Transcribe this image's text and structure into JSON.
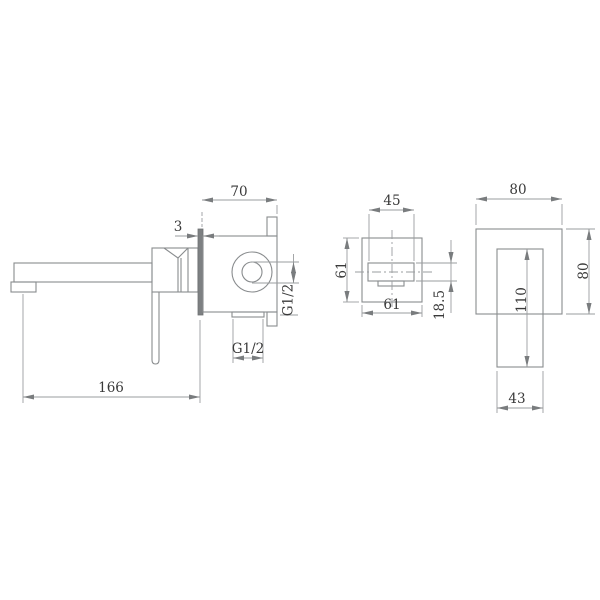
{
  "views": {
    "side": {
      "dims": {
        "depth": "70",
        "wall_plate_thickness": "3",
        "spout_reach": "166",
        "side_inlet_thread": "G1/2",
        "bottom_outlet_thread": "G1/2"
      }
    },
    "spout_front": {
      "dims": {
        "spout_width": "45",
        "plate_height": "61",
        "plate_width": "61",
        "spout_height": "18.5"
      }
    },
    "handle_front": {
      "dims": {
        "plate_width": "80",
        "plate_height": "80",
        "handle_length": "110",
        "handle_width": "43"
      }
    }
  },
  "colors": {
    "line": "#898c8e",
    "dimension_line": "#9a9d9f",
    "text": "#3a3a3a",
    "background": "#ffffff"
  }
}
